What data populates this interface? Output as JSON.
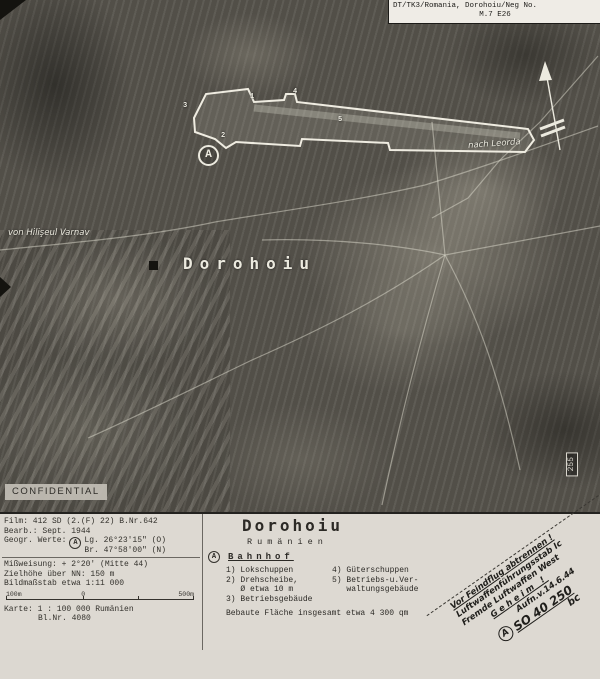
{
  "header": {
    "line1": "DT/TK3/Romania, Dorohoiu/Neg No.",
    "line2": "M.7  E26"
  },
  "photo": {
    "town_label": "Dorohoiu",
    "road_left": "von Hilişeul Varnav",
    "road_right": "nach Leorda",
    "confidential": "CONFIDENTIAL",
    "edge_number": "255",
    "marker_letter": "A",
    "point_markers": [
      "1",
      "2",
      "3",
      "4",
      "5"
    ]
  },
  "panel": {
    "left": {
      "film": "Film: 412 SD (2.(F) 22) B.Nr.642",
      "bearb": "Bearb.: Sept. 1944",
      "geogr_label": "Geogr. Werte:",
      "geogr_marker": "A",
      "geogr_lg": "Lg. 26°23'15\" (O)",
      "geogr_br": "Br. 47°58'00\" (N)",
      "missweisung": "Mißweisung: + 2°20' (Mitte 44)",
      "zielhoehe": "Zielhöhe über NN: 150 m",
      "bildmassstab": "Bildmaßstab etwa  1:11 000",
      "scale_left": "100m",
      "scale_zero": "0",
      "scale_right": "500m",
      "karte": "Karte: 1 : 100 000 Rumänien",
      "blatt": "Bl.Nr. 4080"
    },
    "center": {
      "title": "Dorohoiu",
      "subtitle": "Rumänien",
      "section_marker": "A",
      "section": "Bahnhof",
      "col1": "1) Lokschuppen\n2) Drehscheibe,\n   Ø etwa 10 m\n3) Betriebsgebäude",
      "col2": "4) Güterschuppen\n5) Betriebs-u.Ver-\n   waltungsgebäude",
      "footer": "Bebaute Fläche insgesamt etwa  4 300 qm"
    },
    "corner": {
      "cut_note": "Vor Feindflug abtrennen !",
      "unit1": "Luftwaffenführungsstab Ic",
      "unit2": "Fremde Luftwaffen West",
      "geheim": "Geheim !",
      "date": "Aufn.v.14.6.44",
      "ref_marker": "A",
      "ref": "SO 40 250",
      "ref2": "bc"
    }
  },
  "colors": {
    "photo_base": "#56534c",
    "panel_bg": "#ddd9d2",
    "ink": "#2f2d29",
    "annotation_white": "#eceadf"
  }
}
